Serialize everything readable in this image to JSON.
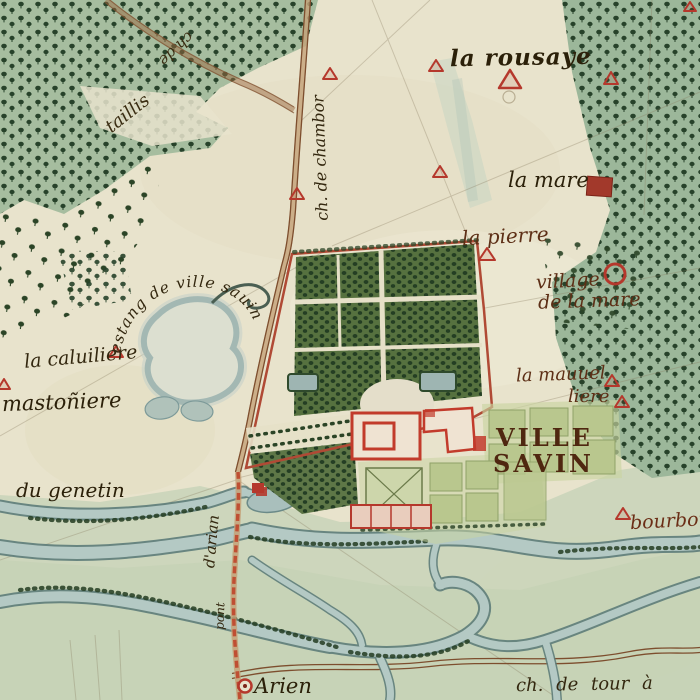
{
  "map": {
    "kind": "hand-drawn historical estate map",
    "place": "Villesavin",
    "labels": {
      "rousaye": "la rousaye",
      "chemin_chambor": "ch. de chambor",
      "taillis": "taillis",
      "chemin_top": "ch de",
      "la_mare": "la mare",
      "la_pierre": "la pierre",
      "village_line1": "village",
      "village_line2": "de la mare",
      "mauuel_line1": "la mauuel",
      "mauuel_line2": "liere",
      "ville": "VILLE",
      "savin": "SAVIN",
      "estang": "estang de ville sauin",
      "caluiliere": "la caluiliere",
      "mastoniere": "mastoñiere",
      "genetin": "du genetin",
      "bourbon": "bourbon",
      "pont": "pont",
      "arian": "d'arian",
      "arien": "Arien",
      "chemin_tour": "ch. de tour à"
    },
    "symbols": {
      "farm_house": "red-outline-triangle",
      "village_marker": "red-circle",
      "manor_la_mare": "red-filled-square",
      "chateau": "red-building-plan",
      "town_arien": "red-ring-dot"
    },
    "colors": {
      "parchment": "#e8e3cc",
      "forest_wash": "#a6bd9f",
      "tree_ink": "#27422a",
      "water": "#b4c9c4",
      "water_edge": "#5e7d7a",
      "building_red": "#b5382c",
      "road_brown": "#7d4e2e",
      "label_ink": "#33270f",
      "parterre_green": "#b9c78e",
      "flood_plain": "#cbd5bb"
    }
  }
}
